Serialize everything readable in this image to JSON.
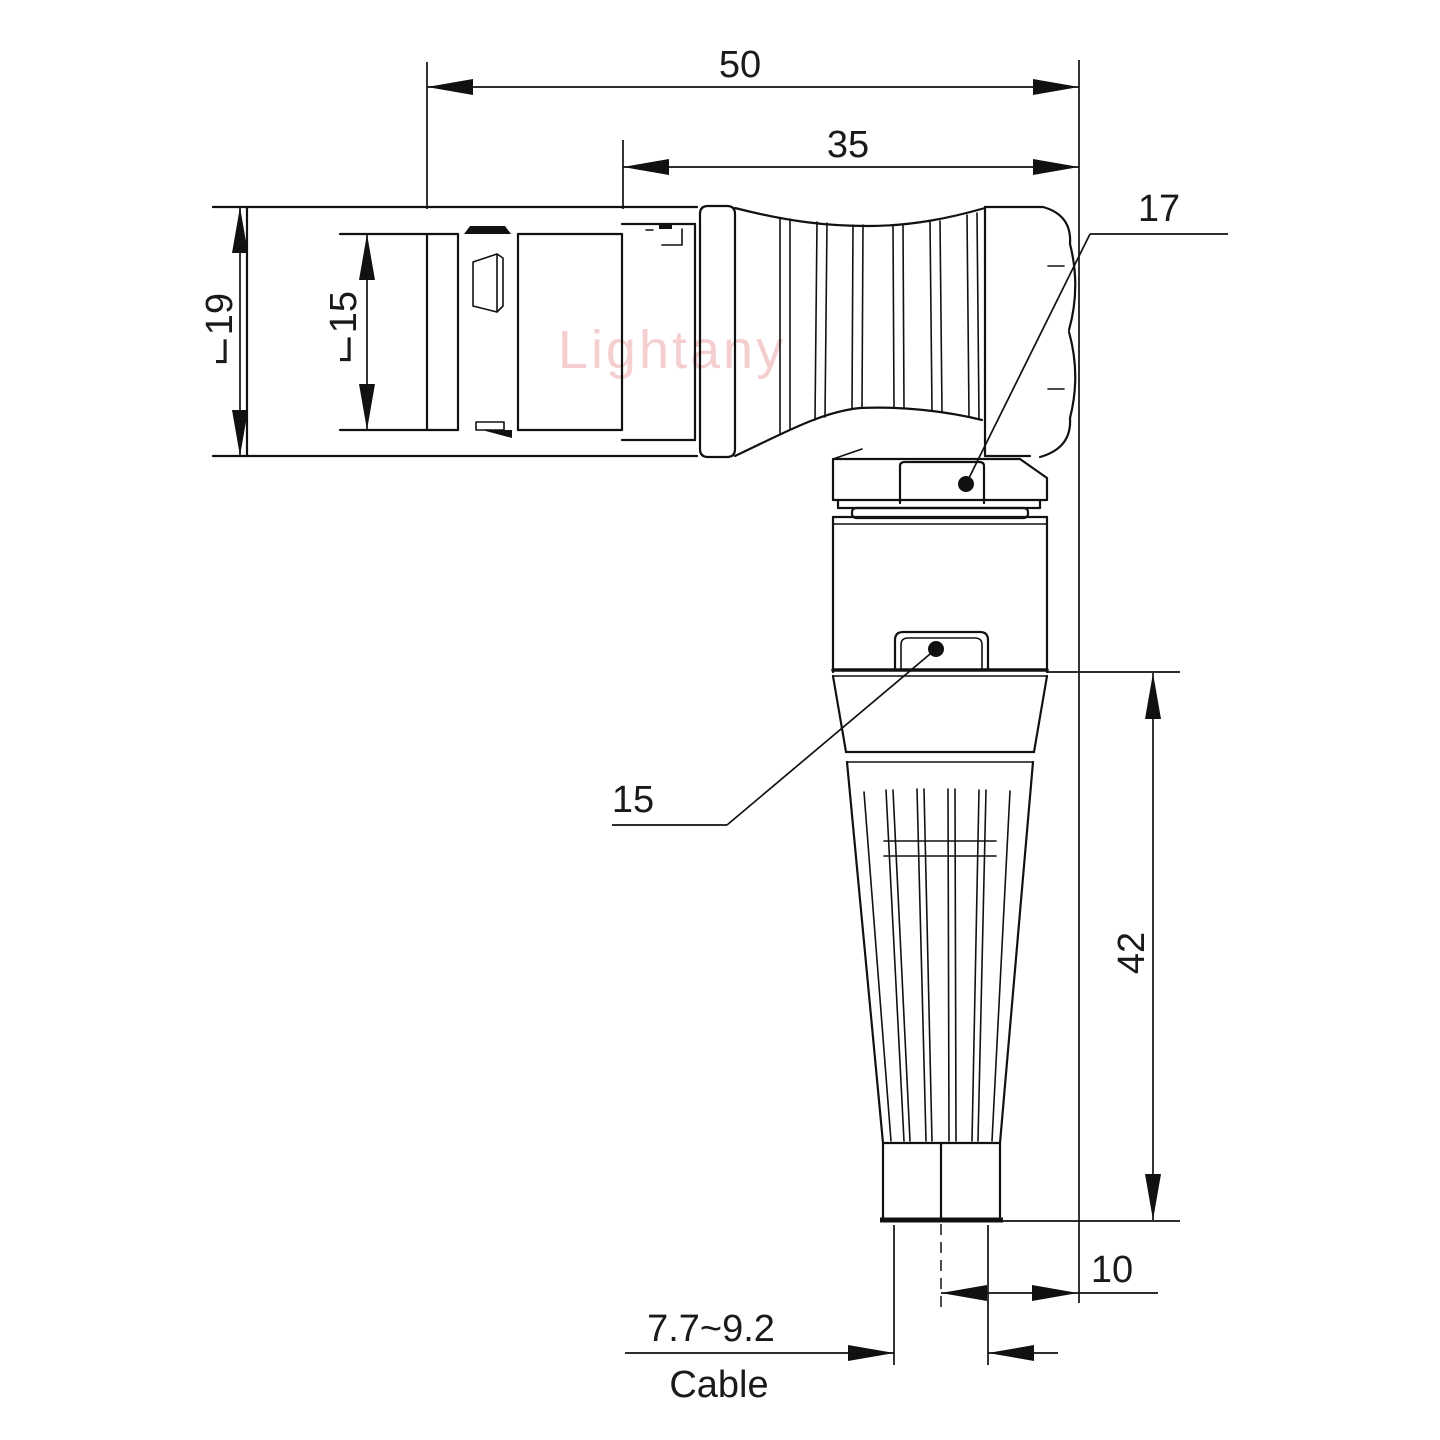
{
  "drawing": {
    "type": "technical-dimension-drawing",
    "subject": "right-angle circular push-pull connector, side view",
    "watermark": "Lightany",
    "line_color": "#111111",
    "watermark_color": "#e88f8f",
    "dimensions": {
      "overall_length": "50",
      "grip_length": "35",
      "outer_diameter": "⌙19",
      "inner_diameter": "⌙15",
      "nut_width": "17",
      "screw_detail": "15",
      "body_height": "42",
      "axis_offset": "10",
      "cable_range": "7.7~9.2",
      "cable_label": "Cable"
    }
  }
}
